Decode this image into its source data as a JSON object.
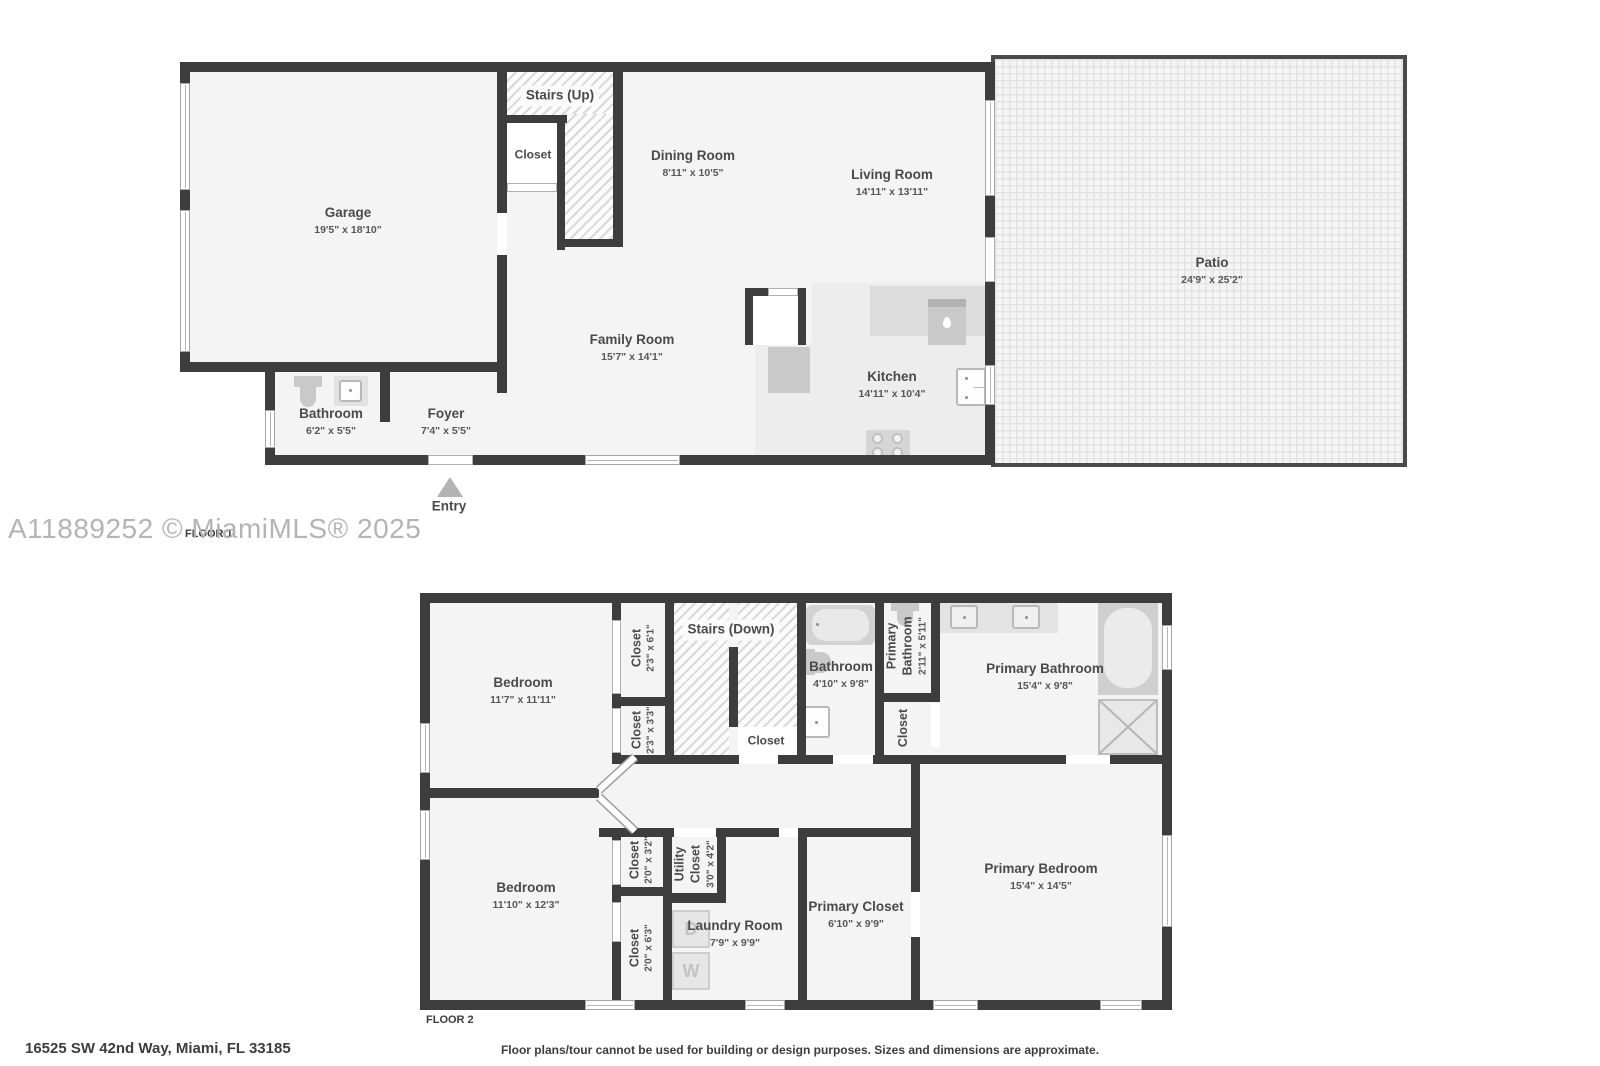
{
  "watermark": "A11889252 © MiamiMLS® 2025",
  "address": "16525 SW 42nd Way, Miami, FL 33185",
  "disclaimer": "Floor plans/tour cannot be used for building or design purposes. Sizes and dimensions are approximate.",
  "floor1": {
    "label": "FLOOR 1",
    "entry": "Entry",
    "rooms": {
      "garage": {
        "name": "Garage",
        "dims": "19'5\" x 18'10\""
      },
      "stairs": {
        "name": "Stairs (Up)"
      },
      "closet": {
        "name": "Closet"
      },
      "dining": {
        "name": "Dining Room",
        "dims": "8'11\" x 10'5\""
      },
      "living": {
        "name": "Living Room",
        "dims": "14'11\" x 13'11\""
      },
      "family": {
        "name": "Family Room",
        "dims": "15'7\" x 14'1\""
      },
      "kitchen": {
        "name": "Kitchen",
        "dims": "14'11\" x 10'4\""
      },
      "bathroom": {
        "name": "Bathroom",
        "dims": "6'2\" x 5'5\""
      },
      "foyer": {
        "name": "Foyer",
        "dims": "7'4\" x 5'5\""
      },
      "patio": {
        "name": "Patio",
        "dims": "24'9\" x 25'2\""
      }
    }
  },
  "floor2": {
    "label": "FLOOR 2",
    "rooms": {
      "bedroom1": {
        "name": "Bedroom",
        "dims": "11'7\" x 11'11\""
      },
      "closet1": {
        "name": "Closet",
        "dims": "2'3\" x 6'1\""
      },
      "closet2": {
        "name": "Closet",
        "dims": "2'3\" x 3'3\""
      },
      "stairs": {
        "name": "Stairs (Down)"
      },
      "stairsCloset": {
        "name": "Closet"
      },
      "bathroom": {
        "name": "Bathroom",
        "dims": "4'10\" x 9'8\""
      },
      "primaryBathSmall": {
        "name": "Primary Bathroom",
        "dims": "2'11\" x 5'11\""
      },
      "closet5": {
        "name": "Closet"
      },
      "primaryBath": {
        "name": "Primary Bathroom",
        "dims": "15'4\" x 9'8\""
      },
      "bedroom2": {
        "name": "Bedroom",
        "dims": "11'10\" x 12'3\""
      },
      "closet3": {
        "name": "Closet",
        "dims": "2'0\" x 3'2\""
      },
      "closet4": {
        "name": "Closet",
        "dims": "2'0\" x 6'3\""
      },
      "utility": {
        "name": "Utility Closet",
        "dims": "3'0\" x 4'2\""
      },
      "laundry": {
        "name": "Laundry Room",
        "dims": "7'9\" x 9'9\""
      },
      "primaryCloset": {
        "name": "Primary Closet",
        "dims": "6'10\" x 9'9\""
      },
      "primaryBedroom": {
        "name": "Primary Bedroom",
        "dims": "15'4\" x 14'5\""
      }
    },
    "appliances": {
      "washer": "W",
      "dryer": "D"
    }
  }
}
